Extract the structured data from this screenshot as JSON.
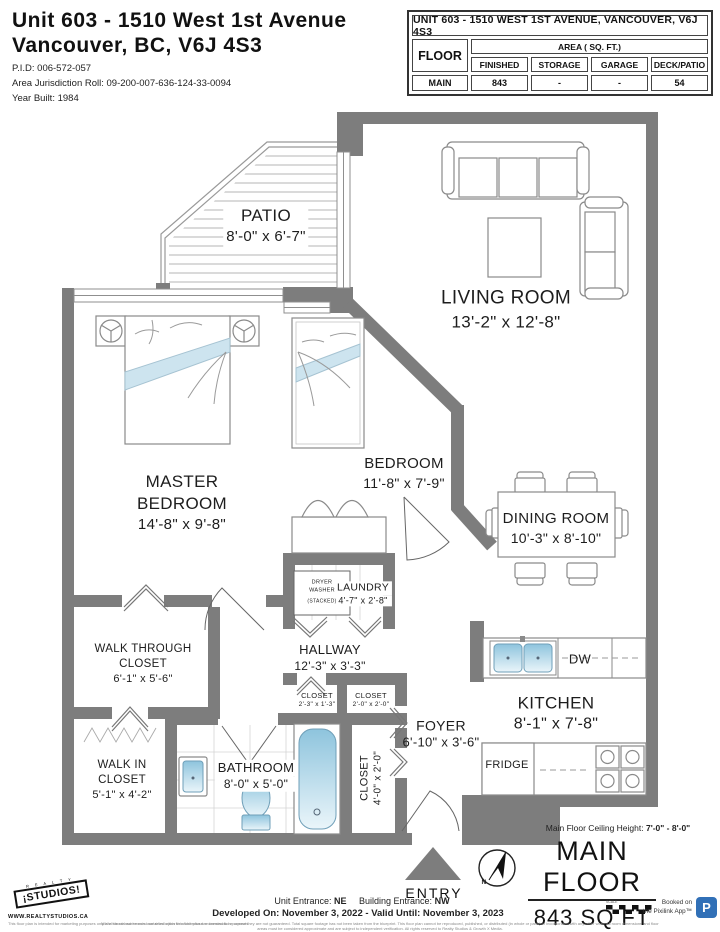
{
  "header": {
    "title1": "Unit 603 - 1510 West 1st Avenue",
    "title2": "Vancouver, BC, V6J 4S3",
    "pid": "P.I.D: 006-572-057",
    "roll": "Area Jurisdiction Roll: 09-200-007-636-124-33-0094",
    "year": "Year Built: 1984"
  },
  "table": {
    "title": "UNIT 603 - 1510 WEST 1ST AVENUE, VANCOUVER, V6J 4S3",
    "floor": "FLOOR",
    "area": "AREA ( SQ. FT.)",
    "columns": [
      "FINISHED",
      "STORAGE",
      "GARAGE",
      "DECK/PATIO"
    ],
    "row_floor": "MAIN",
    "row_finished": "843",
    "row_storage": "-",
    "row_garage": "-",
    "row_deck": "54"
  },
  "plan": {
    "rooms": {
      "patio": {
        "name": "PATIO",
        "dims": "8'-0\" x 6'-7\""
      },
      "living_room": {
        "name": "LIVING ROOM",
        "dims": "13'-2\" x 12'-8\""
      },
      "master_bedroom": {
        "line1": "MASTER",
        "line2": "BEDROOM",
        "dims": "14'-8\" x 9'-8\""
      },
      "bedroom": {
        "name": "BEDROOM",
        "dims": "11'-8\" x 7'-9\""
      },
      "dining_room": {
        "name": "DINING ROOM",
        "dims": "10'-3\" x 8'-10\""
      },
      "laundry": {
        "name": "LAUNDRY",
        "dims": "4'-7\" x 2'-8\""
      },
      "hallway": {
        "name": "HALLWAY",
        "dims": "12'-3\" x 3'-3\""
      },
      "walk_through_closet": {
        "line1": "WALK THROUGH",
        "line2": "CLOSET",
        "dims": "6'-1\" x 5'-6\""
      },
      "closet_small": {
        "name": "CLOSET",
        "dims": "2'-3\" x 1'-3\""
      },
      "closet_mid": {
        "name": "CLOSET",
        "dims": "2'-0\" x 2'-0\""
      },
      "closet_tall": {
        "name": "CLOSET",
        "dims": "4'-0\" x 2'-0\""
      },
      "foyer": {
        "name": "FOYER",
        "dims": "6'-10\" x 3'-6\""
      },
      "walk_in_closet": {
        "line1": "WALK IN",
        "line2": "CLOSET",
        "dims": "5'-1\" x 4'-2\""
      },
      "bathroom": {
        "name": "BATHROOM",
        "dims": "8'-0\" x 5'-0\""
      },
      "kitchen": {
        "name": "KITCHEN",
        "dims": "8'-1\" x 7'-8\""
      }
    },
    "laundry_box": {
      "l1": "DRYER",
      "l2": "WASHER",
      "l3": "(STACKED)"
    },
    "appliances": {
      "dw": "DW",
      "fridge": "FRIDGE"
    },
    "entry": "ENTRY",
    "compass_n": "N"
  },
  "footer": {
    "ceiling_label": "Main Floor Ceiling Height:",
    "ceiling_value": "7'-0\" - 8'-0\"",
    "main_floor": "MAIN FLOOR",
    "sqft": "843 SQ FT",
    "unit_entrance_label": "Unit Entrance:",
    "unit_entrance_value": "NE",
    "building_entrance_label": "Building Entrance:",
    "building_entrance_value": "NW",
    "developed": "Developed On: November 3, 2022 - Valid Until: November 3, 2023",
    "logo_top": "R E A L T Y",
    "logo_text": "¡STUDIOS!",
    "website": "WWW.REALTYSTUDIOS.CA",
    "logo_tagline": "This floor plan is intended for marketing purposes only and should not be used nor relied upon for architectural or construction purposes.",
    "disclaimer": "While the measurements contained within this floor plan are deemed to be correct they are not guaranteed. Total square footage has not been taken from the blueprint. This floor plan cannot be reproduced, published, or distributed (in whole or parts) or incorporated with any other work. All room dimensions and floor areas must be considered approximate and are subject to independent verification. All rights reserved to Realty Studios & Growth X Media.",
    "scale_label": "SCALE",
    "booked1": "Booked on",
    "booked2": "the Pixilink App™",
    "p": "P"
  },
  "colors": {
    "wall": "#7d7d7d",
    "fixture_blue": "#8ec4dd",
    "pixilink_blue": "#3170b7"
  }
}
